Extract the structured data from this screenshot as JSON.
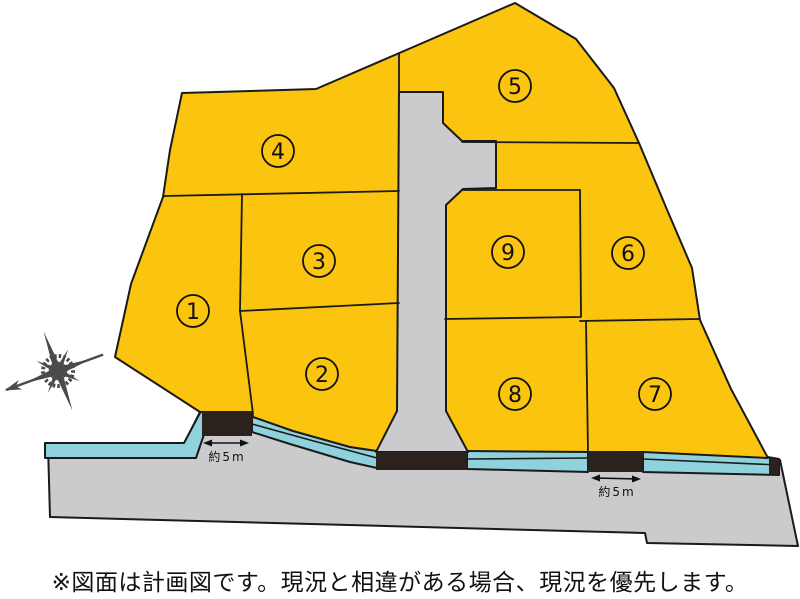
{
  "colors": {
    "lot_fill": "#FBC40E",
    "road_fill": "#CBCBCD",
    "water_fill": "#8FD2DB",
    "entrance_fill": "#2B211D",
    "outline": "#1A1A1A",
    "compass": "#4A4A4A"
  },
  "plan": {
    "lots": [
      {
        "number": "1"
      },
      {
        "number": "2"
      },
      {
        "number": "3"
      },
      {
        "number": "4"
      },
      {
        "number": "5"
      },
      {
        "number": "6"
      },
      {
        "number": "7"
      },
      {
        "number": "8"
      },
      {
        "number": "9"
      }
    ],
    "dimension_labels": [
      {
        "text": "約5m"
      },
      {
        "text": "約5m"
      }
    ]
  },
  "caption": {
    "text": "※図面は計画図です。現況と相違がある場合、現況を優先します。"
  }
}
